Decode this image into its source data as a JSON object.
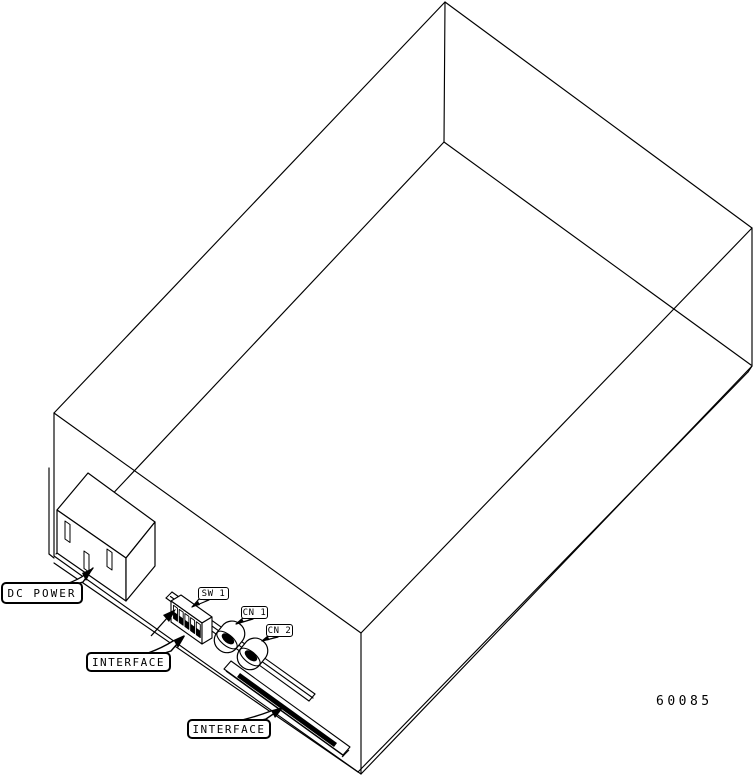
{
  "figure": {
    "number": "60085",
    "labels": {
      "dc_power": "DC POWER",
      "sw1": "SW 1",
      "cn1": "CN 1",
      "cn2": "CN 2",
      "interface_upper": "INTERFACE",
      "interface_lower": "INTERFACE"
    },
    "colors": {
      "line": "#000000",
      "background": "#ffffff"
    }
  }
}
